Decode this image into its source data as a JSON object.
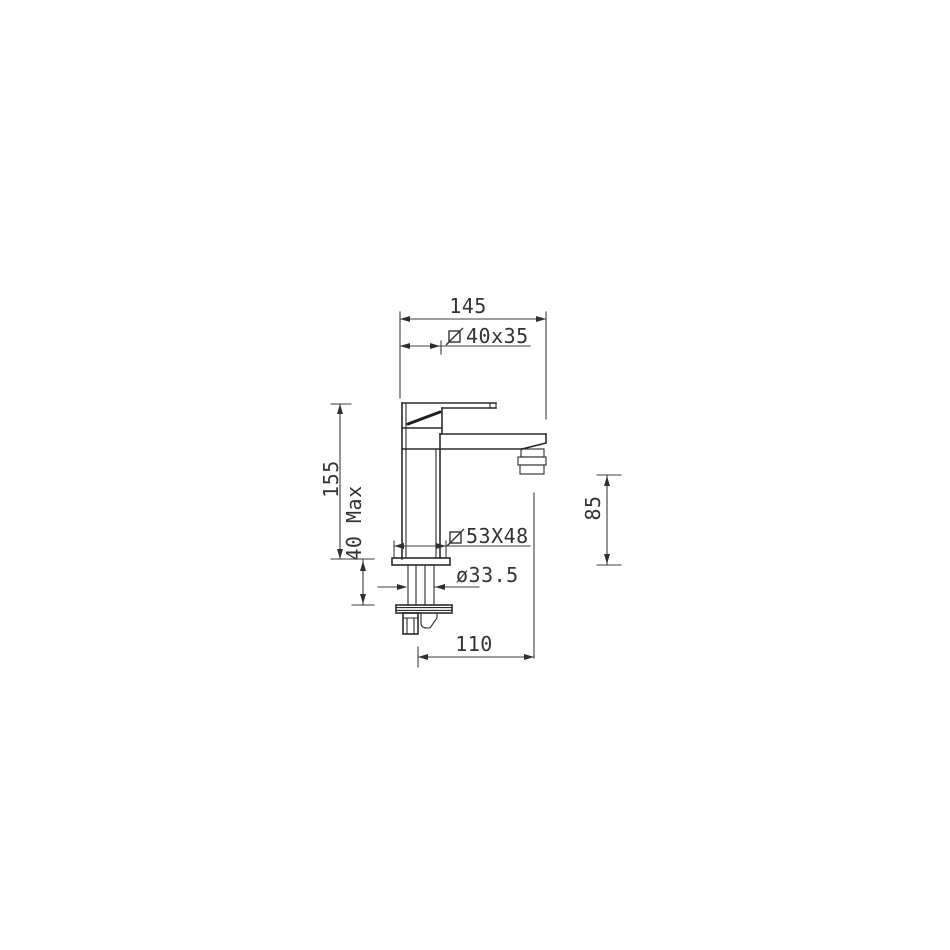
{
  "page": {
    "background": "#ffffff",
    "colors": {
      "outline": "#2b2b2b",
      "dimension_lines": "#3d3d3d",
      "text": "#333333"
    }
  },
  "drawing": {
    "kind": "technical-dimension-drawing",
    "subject": "single-lever-basin-mixer-faucet-side-elevation",
    "dimensions": {
      "overall_width": {
        "value": "145"
      },
      "body_section": {
        "symbol": "square-slash",
        "value": "40x35"
      },
      "body_height": {
        "value": "155"
      },
      "deck_thickness": {
        "value": "40 Max"
      },
      "base_section": {
        "symbol": "square-slash",
        "value": "53X48"
      },
      "shank_diameter": {
        "value": "ø33.5"
      },
      "spout_height": {
        "value": "85"
      },
      "spout_reach": {
        "value": "110"
      }
    }
  }
}
